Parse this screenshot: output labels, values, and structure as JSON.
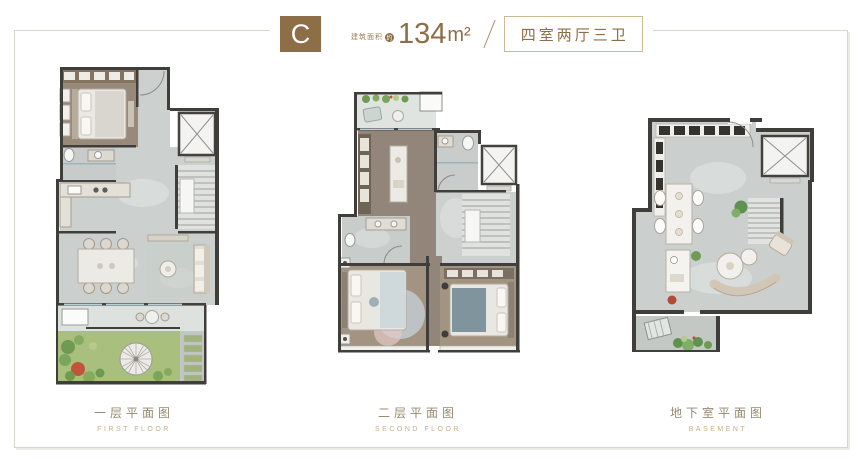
{
  "header": {
    "unit_label": "C",
    "area_label": "建筑面积",
    "area_circle": "约",
    "area_number": "134",
    "area_unit": "m²",
    "layout_text": "四室两厅三卫"
  },
  "plans": [
    {
      "caption_cn": "一层平面图",
      "caption_en": "FIRST FLOOR"
    },
    {
      "caption_cn": "二层平面图",
      "caption_en": "SECOND FLOOR"
    },
    {
      "caption_cn": "地下室平面图",
      "caption_en": "BASEMENT"
    }
  ],
  "colors": {
    "accent_brown": "#8d6e47",
    "layout_box_border": "#cdb995",
    "caption_cn": "#97896f",
    "caption_en": "#c5ad85",
    "frame_border": "#d6d4cb",
    "wall": "#403e3a",
    "floor_marble": "#cbd0ce",
    "floor_wood": "#98897a",
    "terrace_tile": "#dde2df",
    "garden_green": "#a9bf7d",
    "glass_blue": "#b7cfd6",
    "elevator_fill": "#f3f3f1"
  }
}
